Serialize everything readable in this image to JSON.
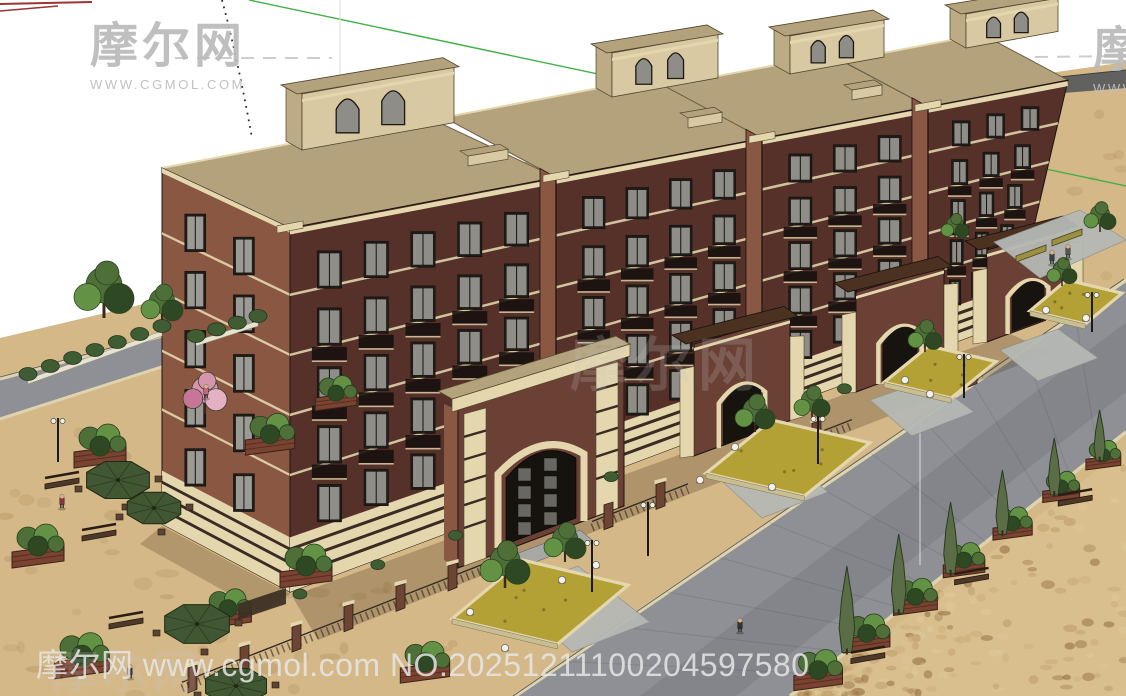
{
  "watermarks": {
    "top_left": {
      "title": "摩尔网",
      "subtitle": "WWW.CGMOL.COM"
    },
    "top_right": {
      "title": "摩尔网",
      "subtitle": "WWW.CGMOL.COM"
    },
    "center": {
      "title": "摩尔网"
    },
    "bottom_left": {
      "title": "摩尔网",
      "subtitle": "WWW.CGMOL.COM"
    },
    "bottom_line": {
      "text": "摩尔网 www.cgmol.com NO.20251211100204597580"
    }
  },
  "palette": {
    "sky": "#ffffff",
    "ground": "#d4b888",
    "ground_mottle": "#b2925f",
    "cobble": "#d9be8e",
    "cobble_dark": "#8f6c3e",
    "road": "#8f9095",
    "road_far": "#616260",
    "curb": "#ddd3ad",
    "walkway": "#b5b8b4",
    "brick_lit": "#8a5743",
    "brick_front": "#553129",
    "brick_mid": "#6a4134",
    "trim_cream": "#e4d7ae",
    "plinth_stripe": "#3a2b23",
    "roof_tan": "#b3a27b",
    "penthouse": "#d9c9a2",
    "penthouse_side": "#bcab84",
    "window_frame": "#1f1c18",
    "window_glass": "#8e8d88",
    "railing": "#17120e",
    "foliage": "#4e6f38",
    "foliage_light": "#639244",
    "foliage_dark": "#2d4823",
    "cypress": "#5b6d47",
    "umbrella": "#415633",
    "planter_wood": "#7a4331",
    "groundcover": "#b3a135",
    "hedge": "#3f5c33",
    "blossom": "#d795ad",
    "gate_roof": "#4a3120",
    "bench_olive": "#9a9040",
    "shadow": "#50351e",
    "guide_green": "#3fb044",
    "guide_red": "#9c3430",
    "guide_gray": "#cdcdcd",
    "guide_dark": "#2b2b2b"
  }
}
